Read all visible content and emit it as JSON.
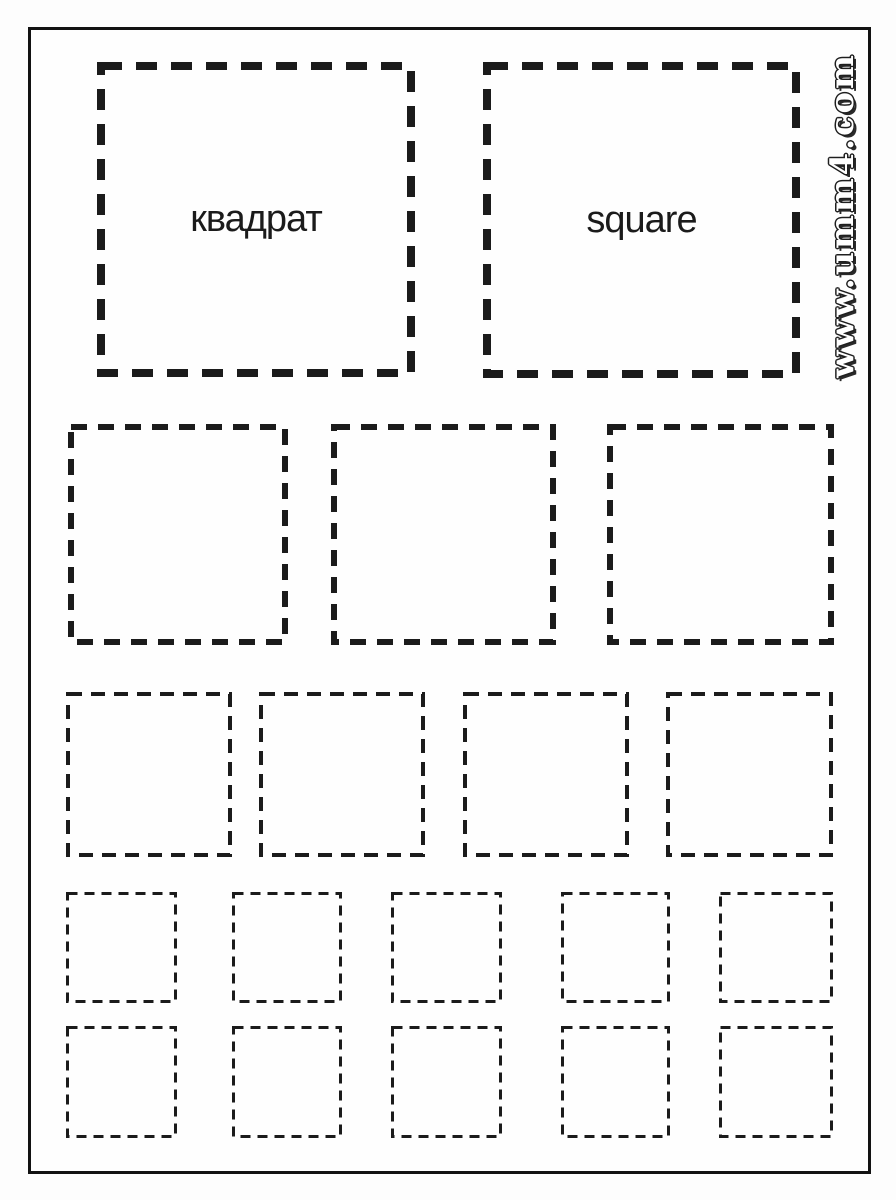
{
  "labels": {
    "russian": "квадрат",
    "english": "square"
  },
  "watermark": {
    "text": "www.umm4.com"
  },
  "colors": {
    "ink": "#1b1b1b",
    "frame": "#121212",
    "paper": "#fdfdfd"
  },
  "rows": [
    {
      "name": "large-labeled-squares",
      "count": 2
    },
    {
      "name": "medium-squares",
      "count": 3
    },
    {
      "name": "small-squares",
      "count": 4
    },
    {
      "name": "tiny-squares-row-1",
      "count": 5
    },
    {
      "name": "tiny-squares-row-2",
      "count": 5
    }
  ]
}
